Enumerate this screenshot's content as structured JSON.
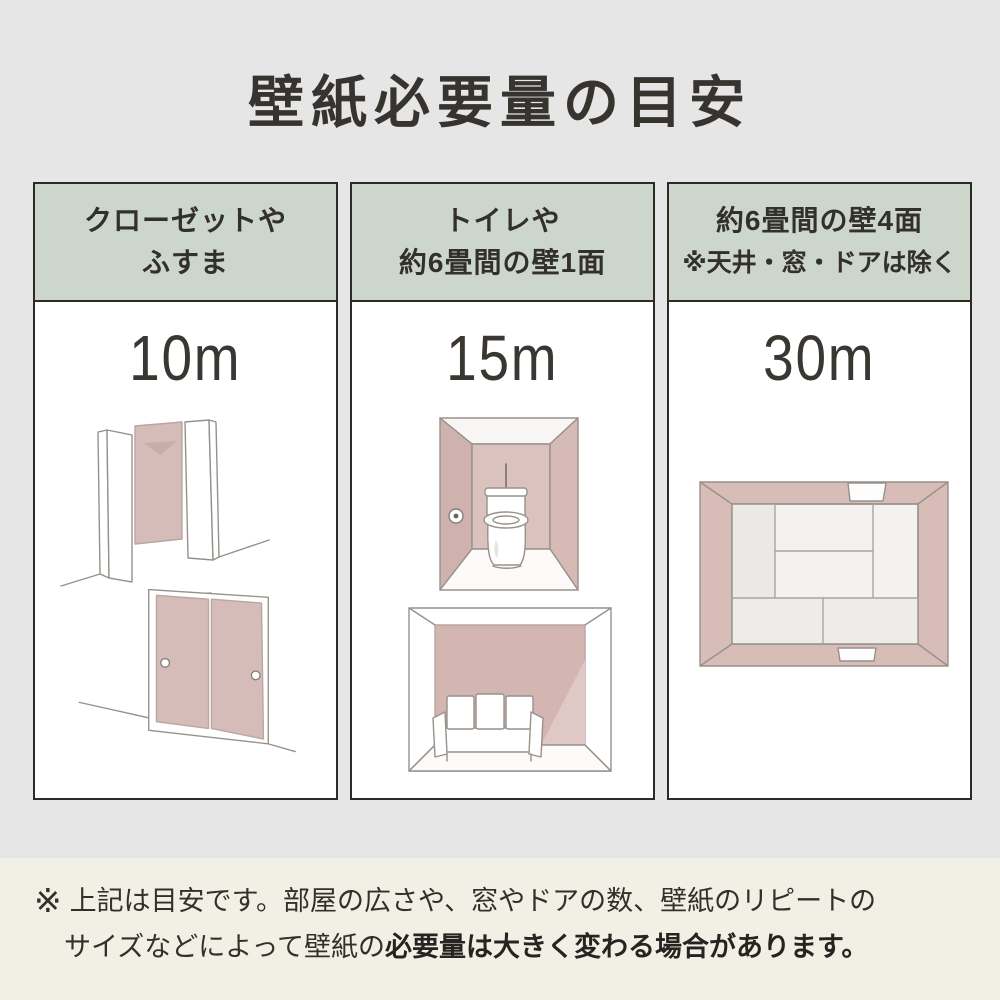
{
  "title": "壁紙必要量の目安",
  "columns": [
    {
      "id": "closet-fusuma",
      "header_line1": "クローゼットや",
      "header_line2": "ふすま",
      "value": "10m",
      "illustrations": [
        "closet-illustration",
        "fusuma-illustration"
      ]
    },
    {
      "id": "toilet-one-wall",
      "header_line1": "トイレや",
      "header_line2": "約6畳間の壁1面",
      "value": "15m",
      "illustrations": [
        "toilet-room-illustration",
        "sofa-room-illustration"
      ]
    },
    {
      "id": "four-walls",
      "header_line1": "約6畳間の壁4面",
      "header_line2": "※天井・窓・ドアは除く",
      "value": "30m",
      "illustrations": [
        "tatami-room-overhead-illustration"
      ]
    }
  ],
  "footer": {
    "marker": "※",
    "line1": "上記は目安です。部屋の広さや、窓やドアの数、壁紙のリピートの",
    "line2_regular": "サイズなどによって壁紙の",
    "line2_bold": "必要量は大きく変わる場合があります。"
  },
  "colors": {
    "background": "#e6e6e7",
    "header_green": "#cdd6ca",
    "card_border": "#2d2a26",
    "wall_pink": "#d6bcb8",
    "footer_cream": "#f2efe5",
    "text": "#37332f"
  }
}
